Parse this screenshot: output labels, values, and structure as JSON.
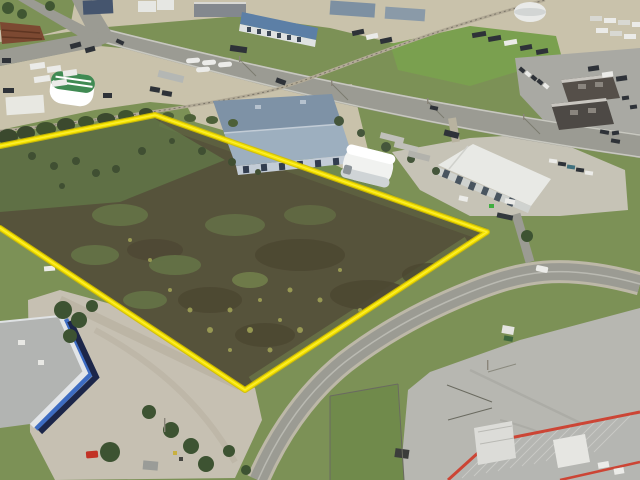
{
  "scene": {
    "description": "Oblique aerial drone photograph of an industrial park. A large vacant brown/green land parcel in the centre is outlined with a bright yellow boundary line. Around it: gravel truck yards, warehouses, quonset huts, a rail line, diagonal roads, parking lots and parked trucks and trailers.",
    "parcel_boundary_points": "0,146 155,115 487,232 245,390 0,228"
  },
  "colors": {
    "boundary_yellow": "#f6e400",
    "boundary_yellow_edge": "#d2be00",
    "field_brown": "#57523a",
    "grass_green": "#7c9156",
    "bright_field_green": "#7aa04f",
    "road_asphalt": "#9b9b93",
    "road_shoulder": "#c0bfb2",
    "gravel_tan": "#c9c2ab",
    "concrete_grey": "#b7b7b1",
    "parking_grey": "#a9a9a3",
    "roof_white": "#e8e9e5",
    "roof_bluegrey_dark": "#7e92a6",
    "roof_bluegrey_light": "#9dafbf",
    "roof_navy": "#44546e",
    "roof_blue": "#5b7fa6",
    "roof_dark_brown": "#55504a",
    "roof_metal_grey": "#b5b6b2",
    "trim_red": "#cc4434",
    "stripe_blue": "#3e6cc2",
    "stripe_navy": "#1c2849",
    "quonset_green": "#3f8a52",
    "tree_dark_green": "#3c5230",
    "shrub_green": "#44563a",
    "rust_brown": "#7c4a30",
    "vehicle_dark": "#2e3338",
    "vehicle_white": "#ebebe8",
    "vehicle_red": "#c23028",
    "rail_line": "#b3ab97"
  }
}
